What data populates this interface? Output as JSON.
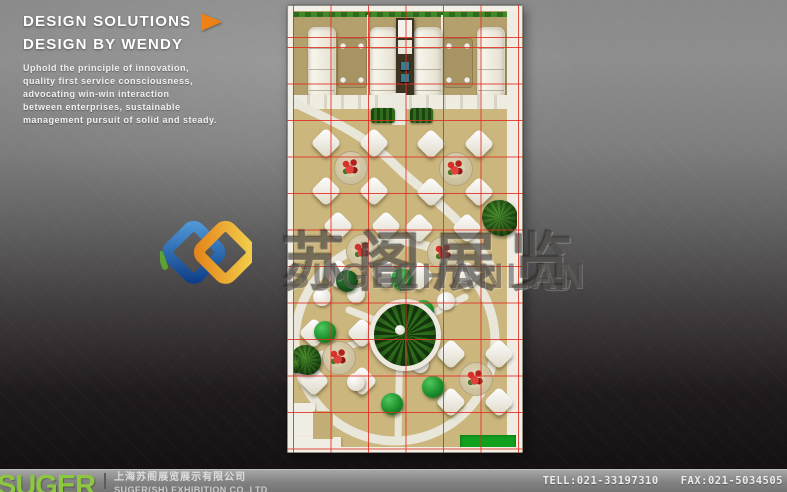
{
  "header": {
    "title_line1": "DESIGN SOLUTIONS",
    "title_line2": "DESIGN BY WENDY",
    "description": "Uphold the principle of innovation,\nquality first service consciousness,\nadvocating win-win interaction\nbetween enterprises, sustainable\nmanagement pursuit of solid and steady.",
    "accent_color": "#ee8113"
  },
  "watermark": {
    "logo": "suge-interlock-logo",
    "logo_colors": {
      "blue": "#1b5bb0",
      "gold": "#f6b21b",
      "green": "#5ea832"
    },
    "cn": "苏阁展览",
    "en": "SUGEZHANLAN"
  },
  "floor_plan": {
    "type": "exhibition-stand-top-view-render",
    "grid_color": "#e02d20",
    "floor_color": "#cbb67e",
    "booth_floor_color": "#b3a06c",
    "walkway_color": "#eceade",
    "plant_color": "#2d6b1c",
    "accent_green_color": "#12a01f",
    "furniture": {
      "sofas": 4,
      "coffee_tables": 2,
      "dining_sets": 6,
      "green_stools": 6,
      "white_stools": 5,
      "center_planter": 1
    }
  },
  "footer": {
    "brand": "SUGER",
    "brand_color": "#8dc63f",
    "company_cn": "上海苏阁展览展示有限公司",
    "company_en": "SUGER(SH) EXHIBITION CO.,LTD",
    "tel": "TELL:021-33197310",
    "fax": "FAX:021-5034505"
  }
}
